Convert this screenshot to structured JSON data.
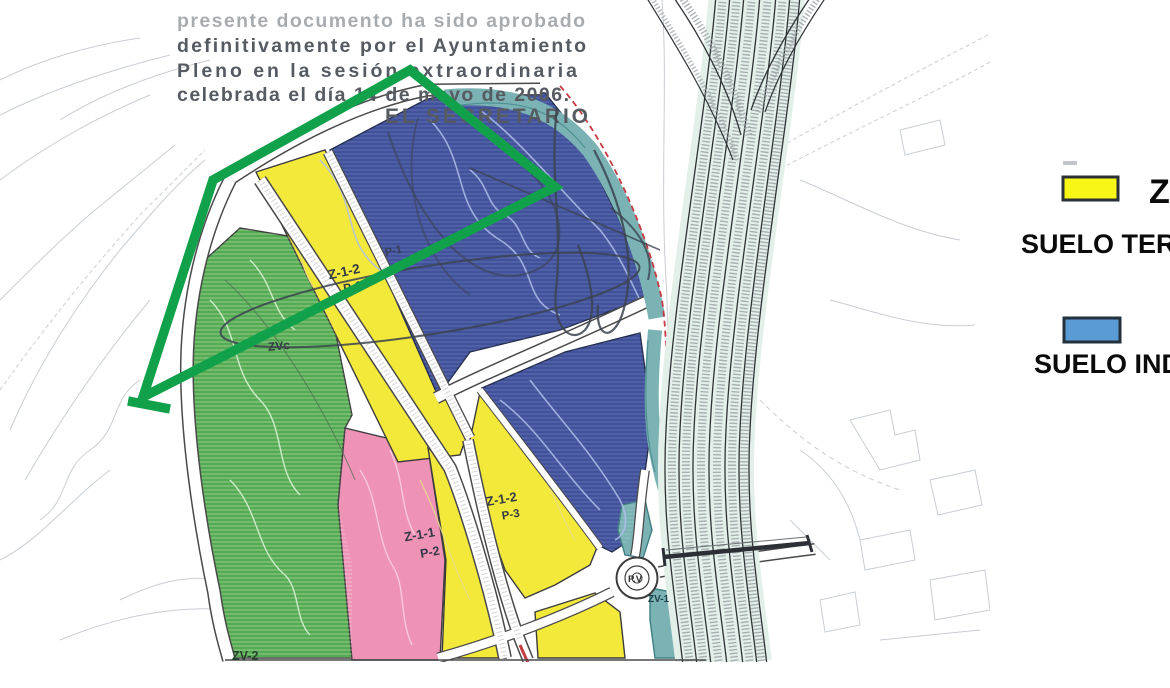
{
  "stamp": {
    "line0": "presente documento ha sido aprobado",
    "line1": "definitivamente por el Ayuntamiento",
    "line2": "Pleno en la sesión extraordinaria",
    "line3": "celebrada el día 14 de mayo de 2006.",
    "line4": "EL SECRETARIO"
  },
  "legend": {
    "items": [
      {
        "title": "Z",
        "label": "SUELO TERC"
      },
      {
        "title": "",
        "label": "SUELO IND"
      }
    ]
  },
  "map_labels": {
    "strip": {
      "code": "Z-1-2",
      "parcel": "P-1"
    },
    "blue_parcel": "P-1",
    "green_label": "ZVc",
    "south_west": {
      "code": "Z-1-1",
      "parcel": "P-2"
    },
    "south_east": {
      "code": "Z-1-2",
      "parcel": "P-3"
    },
    "roundabout": "P.V",
    "roundabout_green": "ZV-1",
    "bottom_green": "ZV-2"
  },
  "colors": {
    "zone_yellow": "#f3e93a",
    "zone_blue": "#41519b",
    "zone_green": "#55ab51",
    "zone_pink": "#ee92b6",
    "zone_teal": "#7bb3b4",
    "overlay_green": "#11a14b",
    "legend_yellow": "#f8f616",
    "legend_blue": "#5b9bd5",
    "boundary_red": "#c63a44"
  }
}
